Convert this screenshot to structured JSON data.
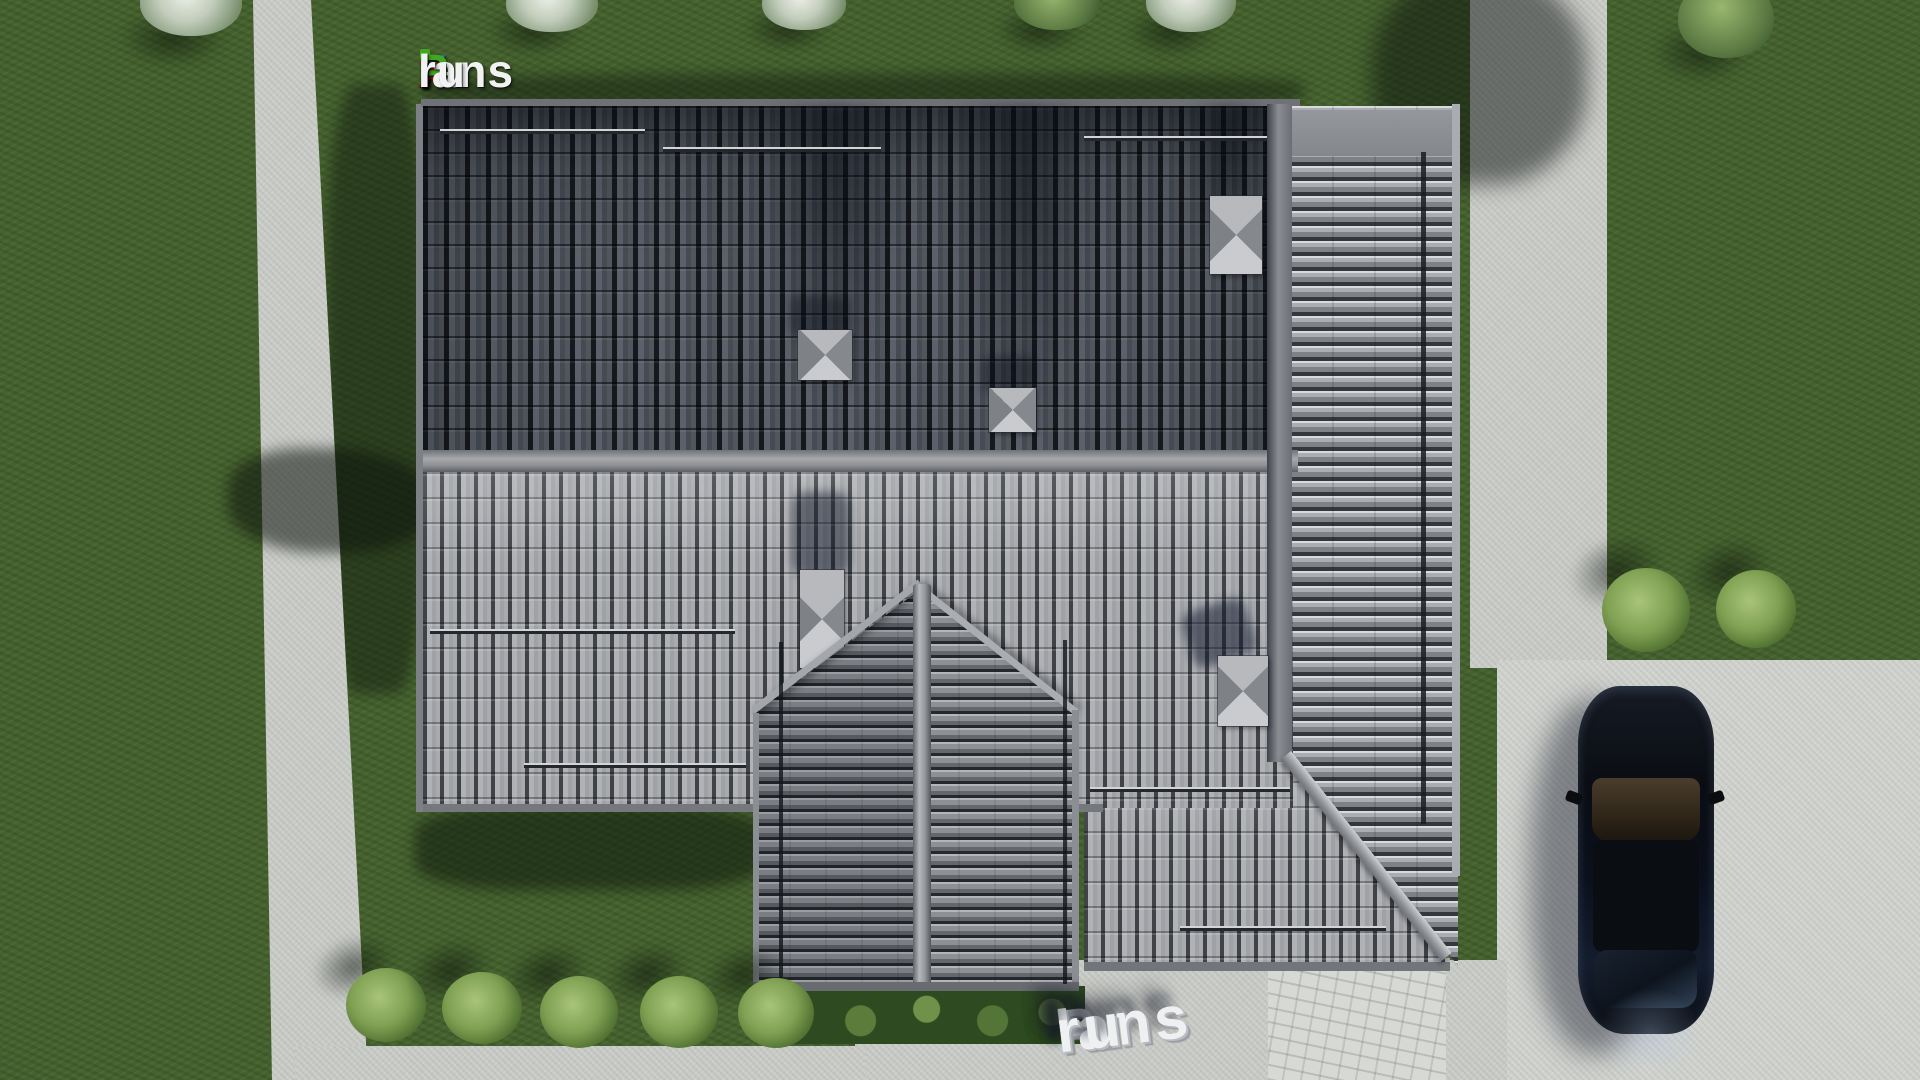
{
  "watermark_top": {
    "f": "F",
    "i": "i",
    "x": "x",
    "p": "P",
    "lans": "lans",
    "dot": ".",
    "ru": "ru"
  },
  "watermark_ground": {
    "p": "P",
    "lans": "lans",
    "dot": ".",
    "ru": "ru"
  },
  "colors": {
    "logo_blue": "#2b7de0",
    "logo_green": "#3fa81e",
    "logo_dark_red": "#8a1c1c",
    "logo_white": "#f2f2f2",
    "ground_dot_blue": "#1f8fe0",
    "grass_green": "#45612e",
    "pavement_gray": "#c9cbc7",
    "roof_dark_gray": "#4e535b",
    "roof_light_gray": "#a7a9ac",
    "ridge_gray": "#9a9da1",
    "car_black": "#0b0e14",
    "bush_green": "#8cab5e"
  }
}
